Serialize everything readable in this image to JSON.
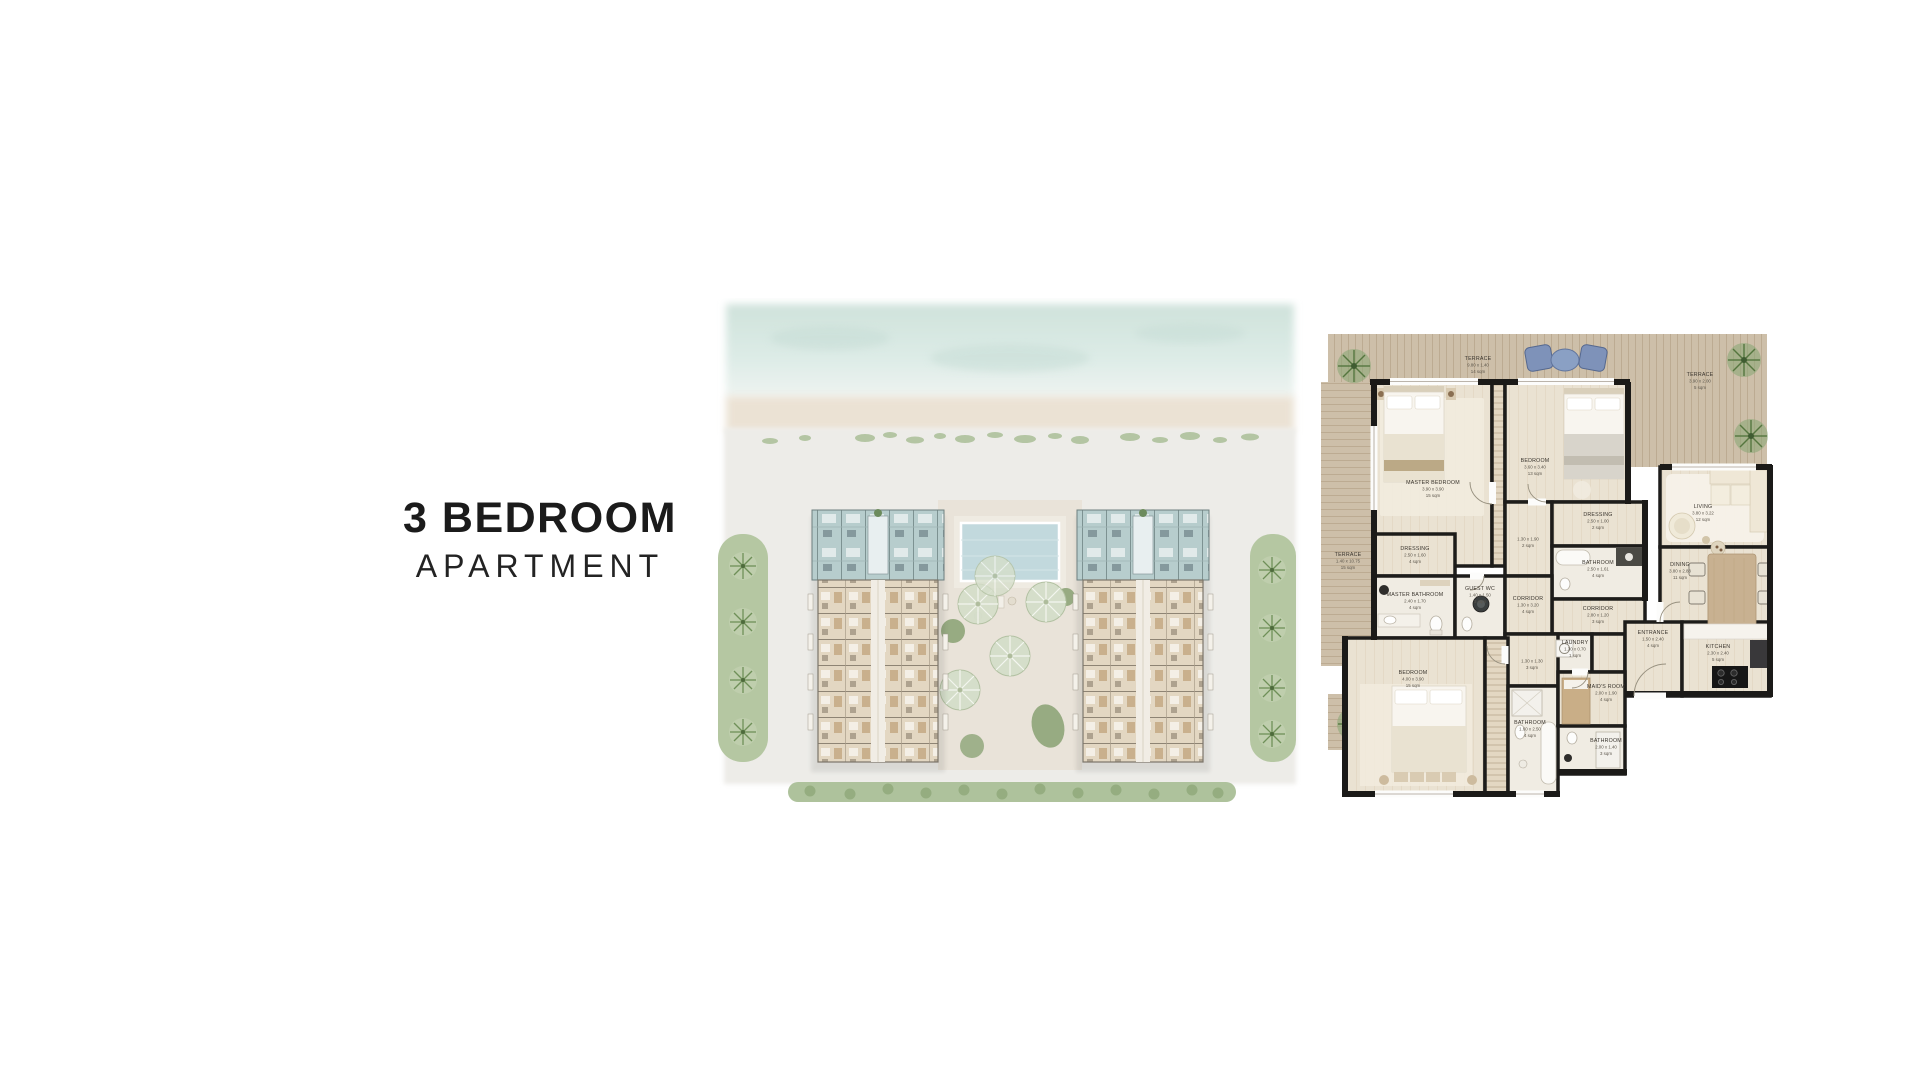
{
  "title": {
    "line1": "3 BEDROOM",
    "line2": "APARTMENT"
  },
  "colors": {
    "text": "#1b1b1b",
    "wall": "#1c1b19",
    "terrace_wood": "#cdbfa9",
    "interior_floor": "#eae2d2",
    "highlight_units_teal": "#b7cdcd",
    "building_beige": "#e3d7c2",
    "pool_blue": "#c2d9dd",
    "sea": "#d5e5e0",
    "greenery": "#a9bf98",
    "accent_chair_blue": "#7e92b9"
  },
  "floor_plan": {
    "rooms": [
      {
        "id": "terrace-top",
        "name": "TERRACE",
        "dims": "9.80 x 1.40",
        "area": "14 sqm"
      },
      {
        "id": "terrace-right",
        "name": "TERRACE",
        "dims": "3.90 x 2.00",
        "area": "5 sqm"
      },
      {
        "id": "terrace-left",
        "name": "TERRACE",
        "dims": "1.40 x 10.75",
        "area": "15 sqm"
      },
      {
        "id": "master-bedroom",
        "name": "MASTER BEDROOM",
        "dims": "3.90 x 3.90",
        "area": "15 sqm"
      },
      {
        "id": "bedroom-2",
        "name": "BEDROOM",
        "dims": "3.60 x 3.40",
        "area": "13 sqm"
      },
      {
        "id": "dressing-master",
        "name": "DRESSING",
        "dims": "2.50 x 1.60",
        "area": "4 sqm"
      },
      {
        "id": "hall",
        "name": "",
        "dims": "1.30 x 1.90",
        "area": "2 sqm"
      },
      {
        "id": "dressing-bedroom",
        "name": "DRESSING",
        "dims": "2.50 x 1.00",
        "area": "2 sqm"
      },
      {
        "id": "bathroom-bedroom",
        "name": "BATHROOM",
        "dims": "2.50 x 1.61",
        "area": "4 sqm"
      },
      {
        "id": "living",
        "name": "LIVING",
        "dims": "3.80 x 3.22",
        "area": "12 sqm"
      },
      {
        "id": "dining",
        "name": "DINING",
        "dims": "3.80 x 2.88",
        "area": "11 sqm"
      },
      {
        "id": "master-bathroom",
        "name": "MASTER BATHROOM",
        "dims": "2.40 x 1.70",
        "area": "4 sqm"
      },
      {
        "id": "guest-wc",
        "name": "GUEST WC",
        "dims": "1.40 x 1.50",
        "area": "3 sqm"
      },
      {
        "id": "corridor-main",
        "name": "CORRIDOR",
        "dims": "1.30 x 3.20",
        "area": "4 sqm"
      },
      {
        "id": "corridor-2",
        "name": "CORRIDOR",
        "dims": "2.80 x 1.20",
        "area": "3 sqm"
      },
      {
        "id": "laundry",
        "name": "LAUNDRY",
        "dims": "1.30 x 0.70",
        "area": "1 sqm"
      },
      {
        "id": "passage",
        "name": "",
        "dims": "1.30 x 1.30",
        "area": "3 sqm"
      },
      {
        "id": "bedroom-3",
        "name": "BEDROOM",
        "dims": "4.00 x 3.90",
        "area": "15 sqm"
      },
      {
        "id": "bathroom-3",
        "name": "BATHROOM",
        "dims": "1.60 x 2.50",
        "area": "4 sqm"
      },
      {
        "id": "maids-room",
        "name": "MAID'S ROOM",
        "dims": "2.00 x 1.90",
        "area": "4 sqm"
      },
      {
        "id": "bathroom-maid",
        "name": "BATHROOM",
        "dims": "2.00 x 1.40",
        "area": "3 sqm"
      },
      {
        "id": "entrance",
        "name": "ENTRANCE",
        "dims": "1.50 x 2.40",
        "area": "4 sqm"
      },
      {
        "id": "kitchen",
        "name": "KITCHEN",
        "dims": "2.30 x 2.40",
        "area": "5 sqm"
      }
    ]
  }
}
